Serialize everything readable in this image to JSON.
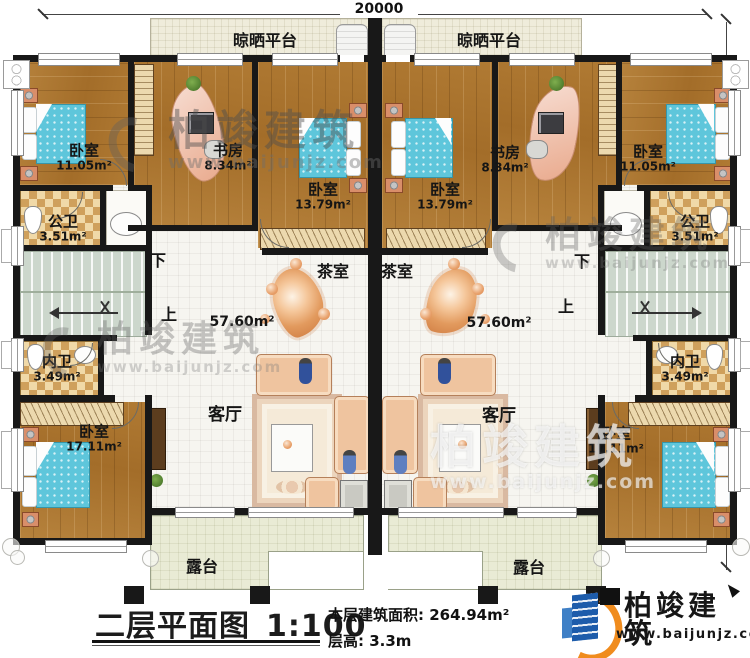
{
  "dimensions": {
    "top_width": "20000",
    "right_height": "16300"
  },
  "labels": {
    "drying_platform": "晾晒平台",
    "tea_room": "茶室",
    "living_room": "客厅",
    "terrace": "露台",
    "hall_area": "57.60m²",
    "stair_up": "上",
    "stair_down": "下"
  },
  "rooms": {
    "bedroom_small": {
      "name": "卧室",
      "area": "11.05m²"
    },
    "study": {
      "name": "书房",
      "area": "8.34m²"
    },
    "bedroom_mid": {
      "name": "卧室",
      "area": "13.79m²"
    },
    "public_bath": {
      "name": "公卫",
      "area": "3.51m²"
    },
    "inner_bath": {
      "name": "内卫",
      "area": "3.49m²"
    },
    "bedroom_large": {
      "name": "卧室",
      "area": "17.11m²"
    }
  },
  "title_block": {
    "plan_title": "二层平面图",
    "scale": "1:100",
    "floor_area": "本层建筑面积: 264.94m²",
    "floor_height": "层高: 3.3m"
  },
  "brand": {
    "name": "柏竣建筑",
    "website": "www.baijunjz.com",
    "blue": "#1d5cab",
    "orange": "#f08c1e"
  },
  "watermark": {
    "name": "柏竣建筑",
    "website": "www.baijunjz.com"
  }
}
